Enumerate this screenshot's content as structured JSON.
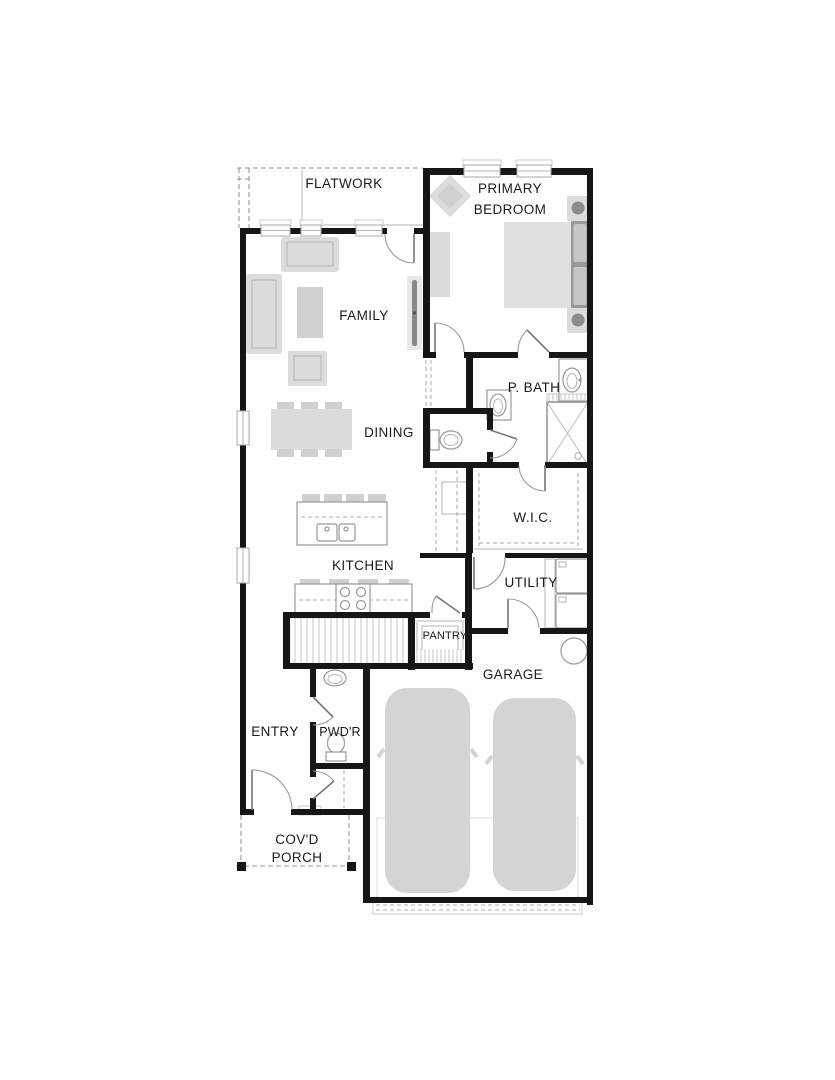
{
  "plan": {
    "labels": {
      "flatwork": "FLATWORK",
      "primary_line1": "PRIMARY",
      "primary_line2": "BEDROOM",
      "family": "FAMILY",
      "p_bath": "P. BATH",
      "dining": "DINING",
      "wic": "W.I.C.",
      "kitchen": "KITCHEN",
      "utility": "UTILITY",
      "pantry": "PANTRY",
      "garage": "GARAGE",
      "entry": "ENTRY",
      "powder": "PWD'R",
      "porch_line1": "COV'D",
      "porch_line2": "PORCH"
    },
    "colors": {
      "background": "#ffffff",
      "wall": "#161616",
      "furniture": "#dcdcdc",
      "furniture_dark": "#9a9a9a",
      "fixture_line": "#999999",
      "hatch": "#c6c6c6",
      "label_text": "#1a1a1a"
    }
  }
}
